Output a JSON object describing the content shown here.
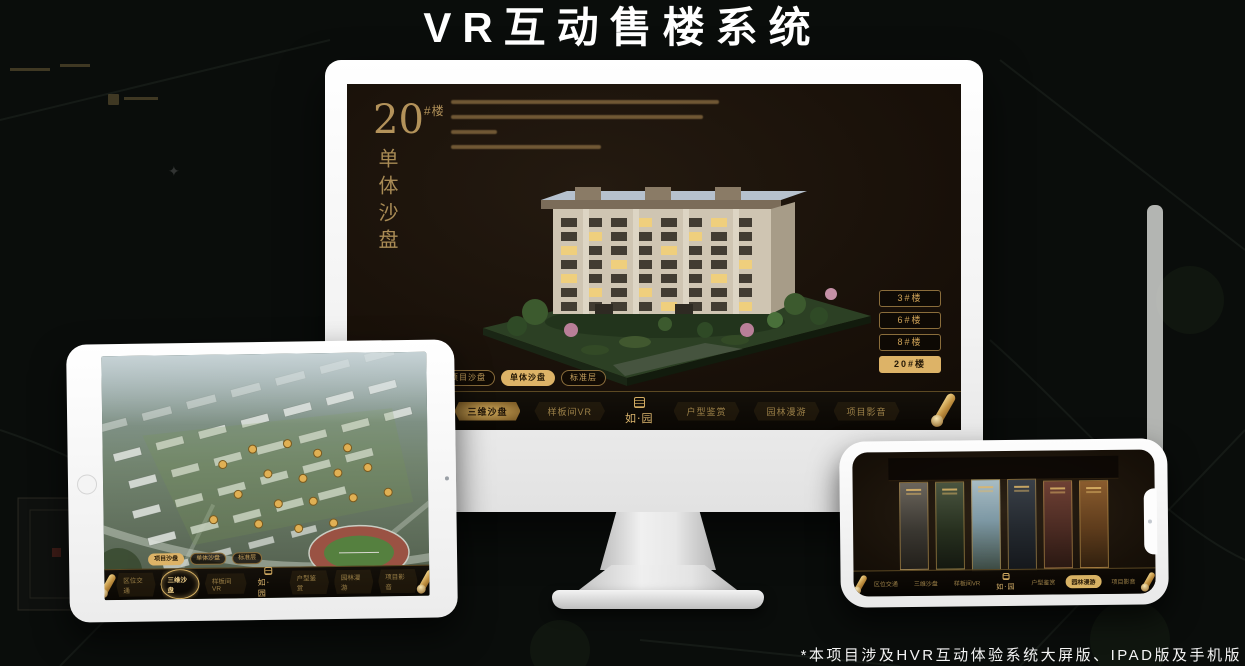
{
  "page": {
    "title": "VR互动售楼系统",
    "footnote": "*本项目涉及HVR互动体验系统大屏版、IPAD版及手机版"
  },
  "colors": {
    "accent_gold": "#d2ab62",
    "panel_dark": "#120d07",
    "background": "#0a0d0b",
    "text_white": "#ffffff"
  },
  "app": {
    "tabs": [
      {
        "label": "项目沙盘"
      },
      {
        "label": "单体沙盘"
      },
      {
        "label": "标准层"
      }
    ],
    "nav": {
      "items": [
        {
          "label": "区位交通"
        },
        {
          "label": "三维沙盘"
        },
        {
          "label": "样板间VR"
        },
        {
          "label": "户型鉴赏"
        },
        {
          "label": "园林漫游"
        },
        {
          "label": "项目影音"
        }
      ],
      "logo_text": "如·园"
    }
  },
  "monitor": {
    "building_number": "20",
    "building_suffix": "#楼",
    "section_title": "单体沙盘",
    "active_tab": "单体沙盘",
    "active_nav": "三维沙盘",
    "floor_buttons": [
      {
        "label": "3#楼",
        "active": false
      },
      {
        "label": "6#楼",
        "active": false
      },
      {
        "label": "8#楼",
        "active": false
      },
      {
        "label": "20#楼",
        "active": true
      }
    ]
  },
  "tablet": {
    "active_tab": "项目沙盘",
    "active_nav": "三维沙盘"
  },
  "phone": {
    "active_nav": "园林漫游",
    "gallery_cards": 6
  }
}
